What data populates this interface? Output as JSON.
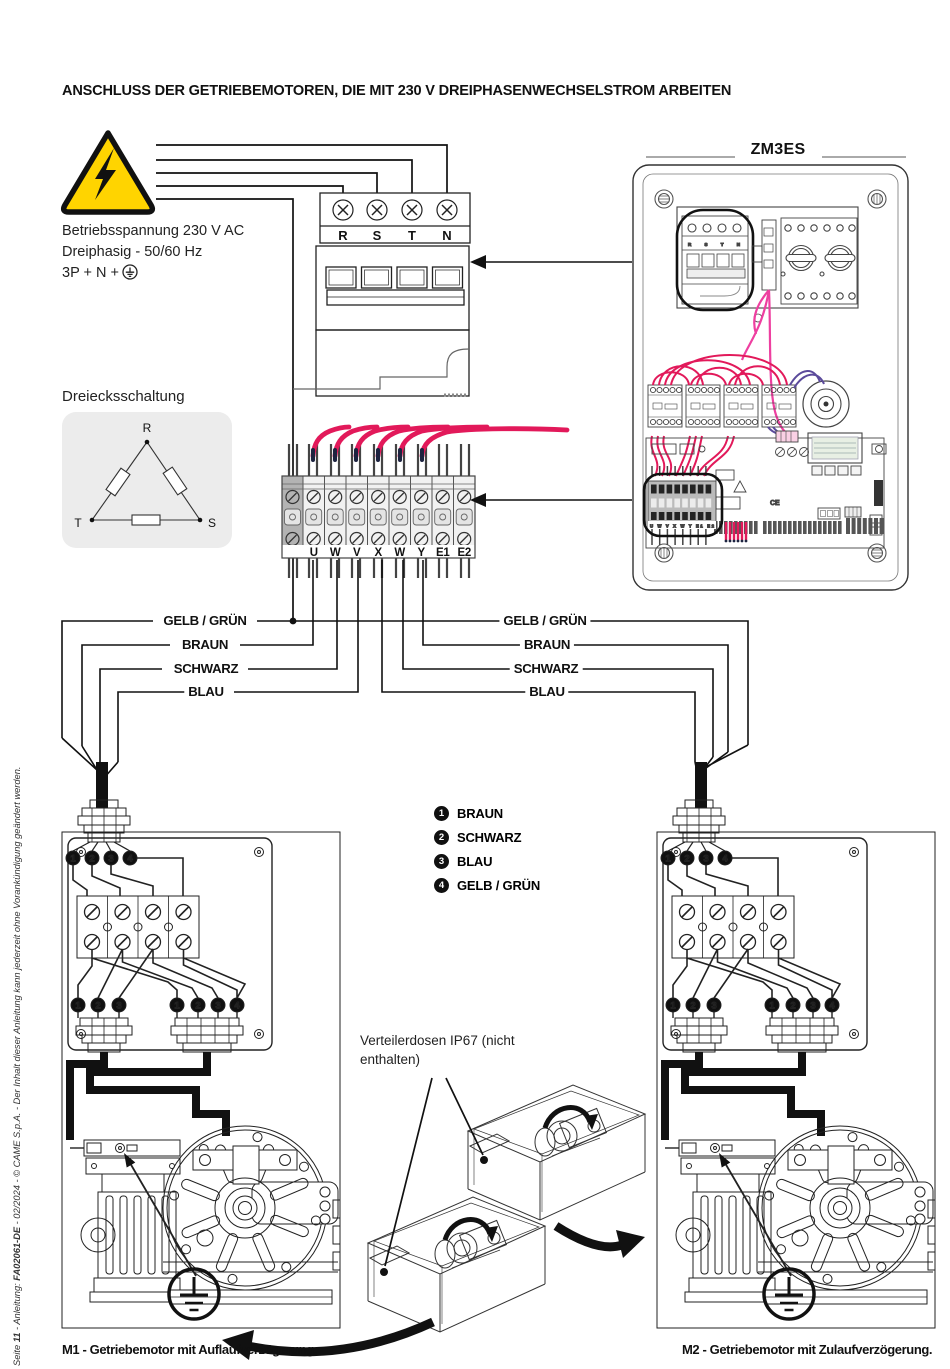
{
  "title": "ANSCHLUSS DER GETRIEBEMOTOREN, DIE MIT 230 V DREIPHASENWECHSELSTROM ARBEITEN",
  "intro": {
    "line1": "Betriebsspannung 230 V AC",
    "line2": "Dreiphasig - 50/60 Hz",
    "line3": "3P + N +"
  },
  "breaker": {
    "labels": [
      "R",
      "S",
      "T",
      "N"
    ]
  },
  "delta": {
    "caption": "Dreiecksschaltung",
    "top": "R",
    "left": "T",
    "right": "S"
  },
  "strip": {
    "labels": [
      "U",
      "W",
      "V",
      "X",
      "W",
      "Y",
      "E1",
      "E2"
    ]
  },
  "panel": {
    "title": "ZM3ES",
    "mini_breaker_labels": "R S T N",
    "mini_strip_labels": "U W V X W Y E1 E2",
    "ce": "CE"
  },
  "wires": {
    "left": [
      "GELB / GRÜN",
      "BRAUN",
      "SCHWARZ",
      "BLAU"
    ],
    "right": [
      "GELB / GRÜN",
      "BRAUN",
      "SCHWARZ",
      "BLAU"
    ]
  },
  "legend": [
    {
      "n": "1",
      "label": "BRAUN"
    },
    {
      "n": "2",
      "label": "SCHWARZ"
    },
    {
      "n": "3",
      "label": "BLAU"
    },
    {
      "n": "4",
      "label": "GELB / GRÜN"
    }
  ],
  "numbers": [
    "1",
    "2",
    "3",
    "4"
  ],
  "note": {
    "line1": "Verteilerdosen IP67 (nicht",
    "line2": "enthalten)"
  },
  "captions": {
    "m1": "M1 - Getriebemotor mit Auflaufverzögerung.",
    "m2": "M2 - Getriebemotor mit Zulaufverzögerung."
  },
  "footer": {
    "seite": "Seite ",
    "page": "11",
    "mid": " - Anleitung: ",
    "code": "FA02061-DE",
    "rest": " - 02/2024 - © CAME S.p.A. - Der Inhalt dieser Anleitung kann jederzeit ohne Vorankündigung geändert werden."
  },
  "colors": {
    "warning_yellow": "#ffd400",
    "wire_pink": "#e2195a",
    "wire_magenta": "#ee3fa0",
    "wire_violet": "#5b4a9b"
  }
}
